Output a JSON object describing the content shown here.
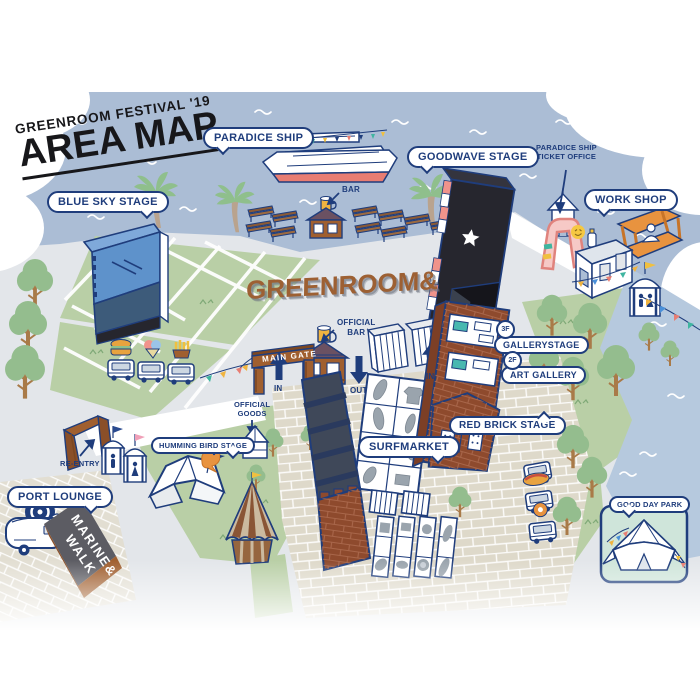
{
  "title": {
    "line1": "GREENROOM FESTIVAL '19",
    "line2": "AREA MAP"
  },
  "labels": {
    "paradice_ship": "PARADICE SHIP",
    "goodwave_stage": "GOODWAVE STAGE",
    "ticket_office_line1": "PARADICE SHIP",
    "ticket_office_line2": "TICKET OFFICE",
    "work_shop": "WORK SHOP",
    "blue_sky_stage": "BLUE SKY STAGE",
    "bar": "BAR",
    "greenroom_sign": "GREENROOM&",
    "official_bar_line1": "OFFICIAL",
    "official_bar_line2": "BAR",
    "main_gate": "MAIN GATE",
    "gate_in": "IN",
    "gate_out": "OUT",
    "market_in": "IN",
    "floor_3f": "3F",
    "gallerystage": "GALLERYSTAGE",
    "floor_2f": "2F",
    "art_gallery": "ART GALLERY",
    "red_brick_stage": "RED BRICK STAGE",
    "official_goods_line1": "OFFICIAL",
    "official_goods_line2": "GOODS",
    "re_entry": "RE-ENTRY",
    "humming_bird_stage": "HUMMING BIRD STAGE",
    "surfmarket": "SURFMARKET",
    "port_lounge": "PORT LOUNGE",
    "marine_walk_line1": "MARINE&",
    "marine_walk_line2": "WALK",
    "good_day_park": "GOOD DAY PARK"
  },
  "colors": {
    "navy": "#1f3d7c",
    "sky_and_sea": "#abbdd5",
    "ground": "#e3e6ea",
    "lawn": "#b9cfa6",
    "pavement": "#ded9ca",
    "red_brick": "#8e4a2d",
    "wood_brown": "#a05f2f",
    "stage_black": "#27272f",
    "stage_blue": "#5e92cb",
    "river": "#b6c9de",
    "good_day_park_bg": "#cfe5da",
    "salmon": "#f0938b",
    "orange": "#e8933f",
    "title_black": "#17171a",
    "sign_brown": "#9d6033"
  }
}
